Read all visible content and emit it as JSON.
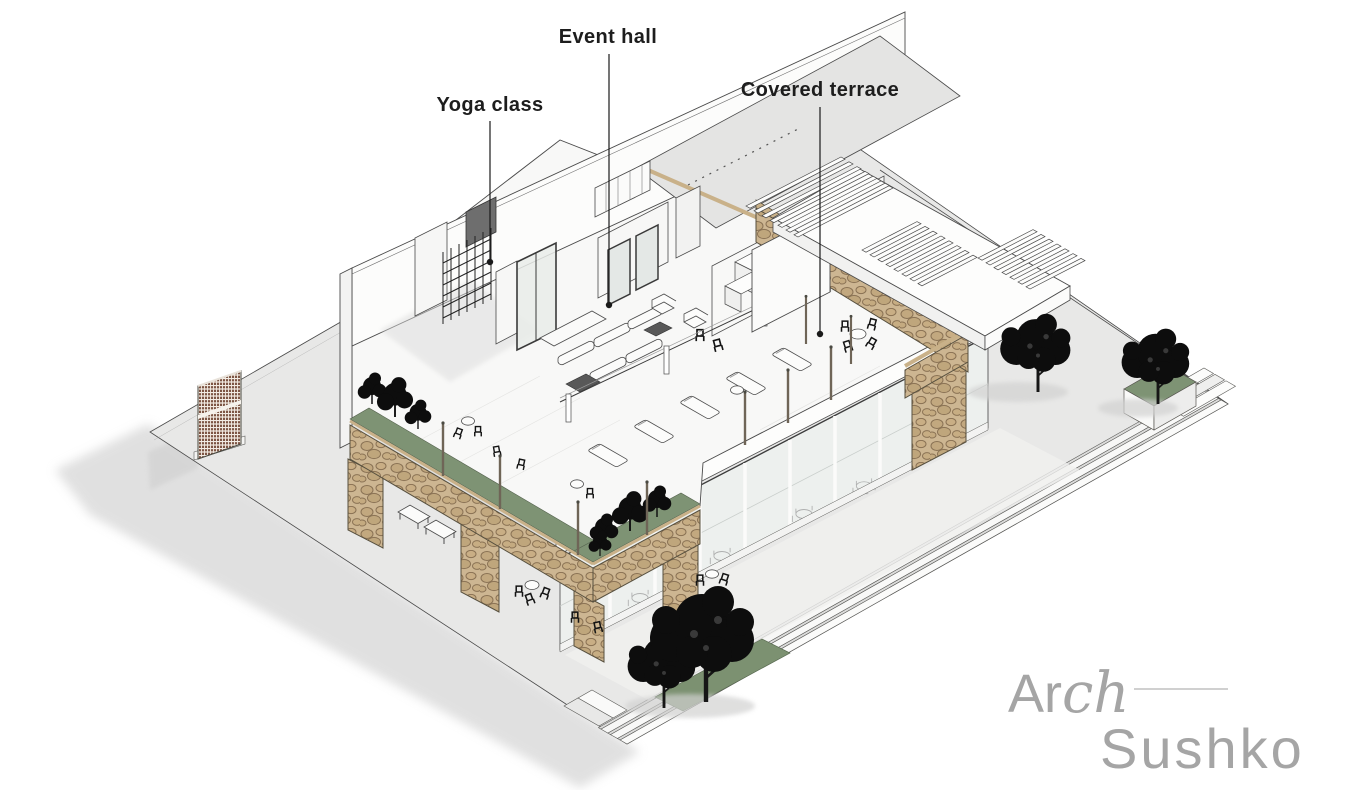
{
  "scene_title": "Wellness club building — cutaway axonometric",
  "labels": {
    "yoga_class": "Yoga class",
    "event_hall": "Event hall",
    "covered_terrace": "Covered terrace"
  },
  "logo": {
    "arch_prefix": "Ar",
    "arch_script": "ch",
    "studio_name": "Sushko"
  },
  "palette": {
    "background": "#ffffff",
    "label_text": "#1d1d1d",
    "leader_line": "#1a1a1a",
    "logo_gray": "#a5a5a5",
    "ground_gray": "#e8e8e7",
    "step_white": "#fbfbfa",
    "stone_tan": "#cdb692",
    "stone_joint": "#8a7254",
    "planter_green": "#7e9374",
    "lattice_brown": "#7d5544",
    "wood_post": "#6f6557",
    "glass_tint": "#edf0ee",
    "roof_gray": "#e4e4e3",
    "tree_black": "#0d0d0d",
    "outline_ink": "#4a4a4a"
  }
}
